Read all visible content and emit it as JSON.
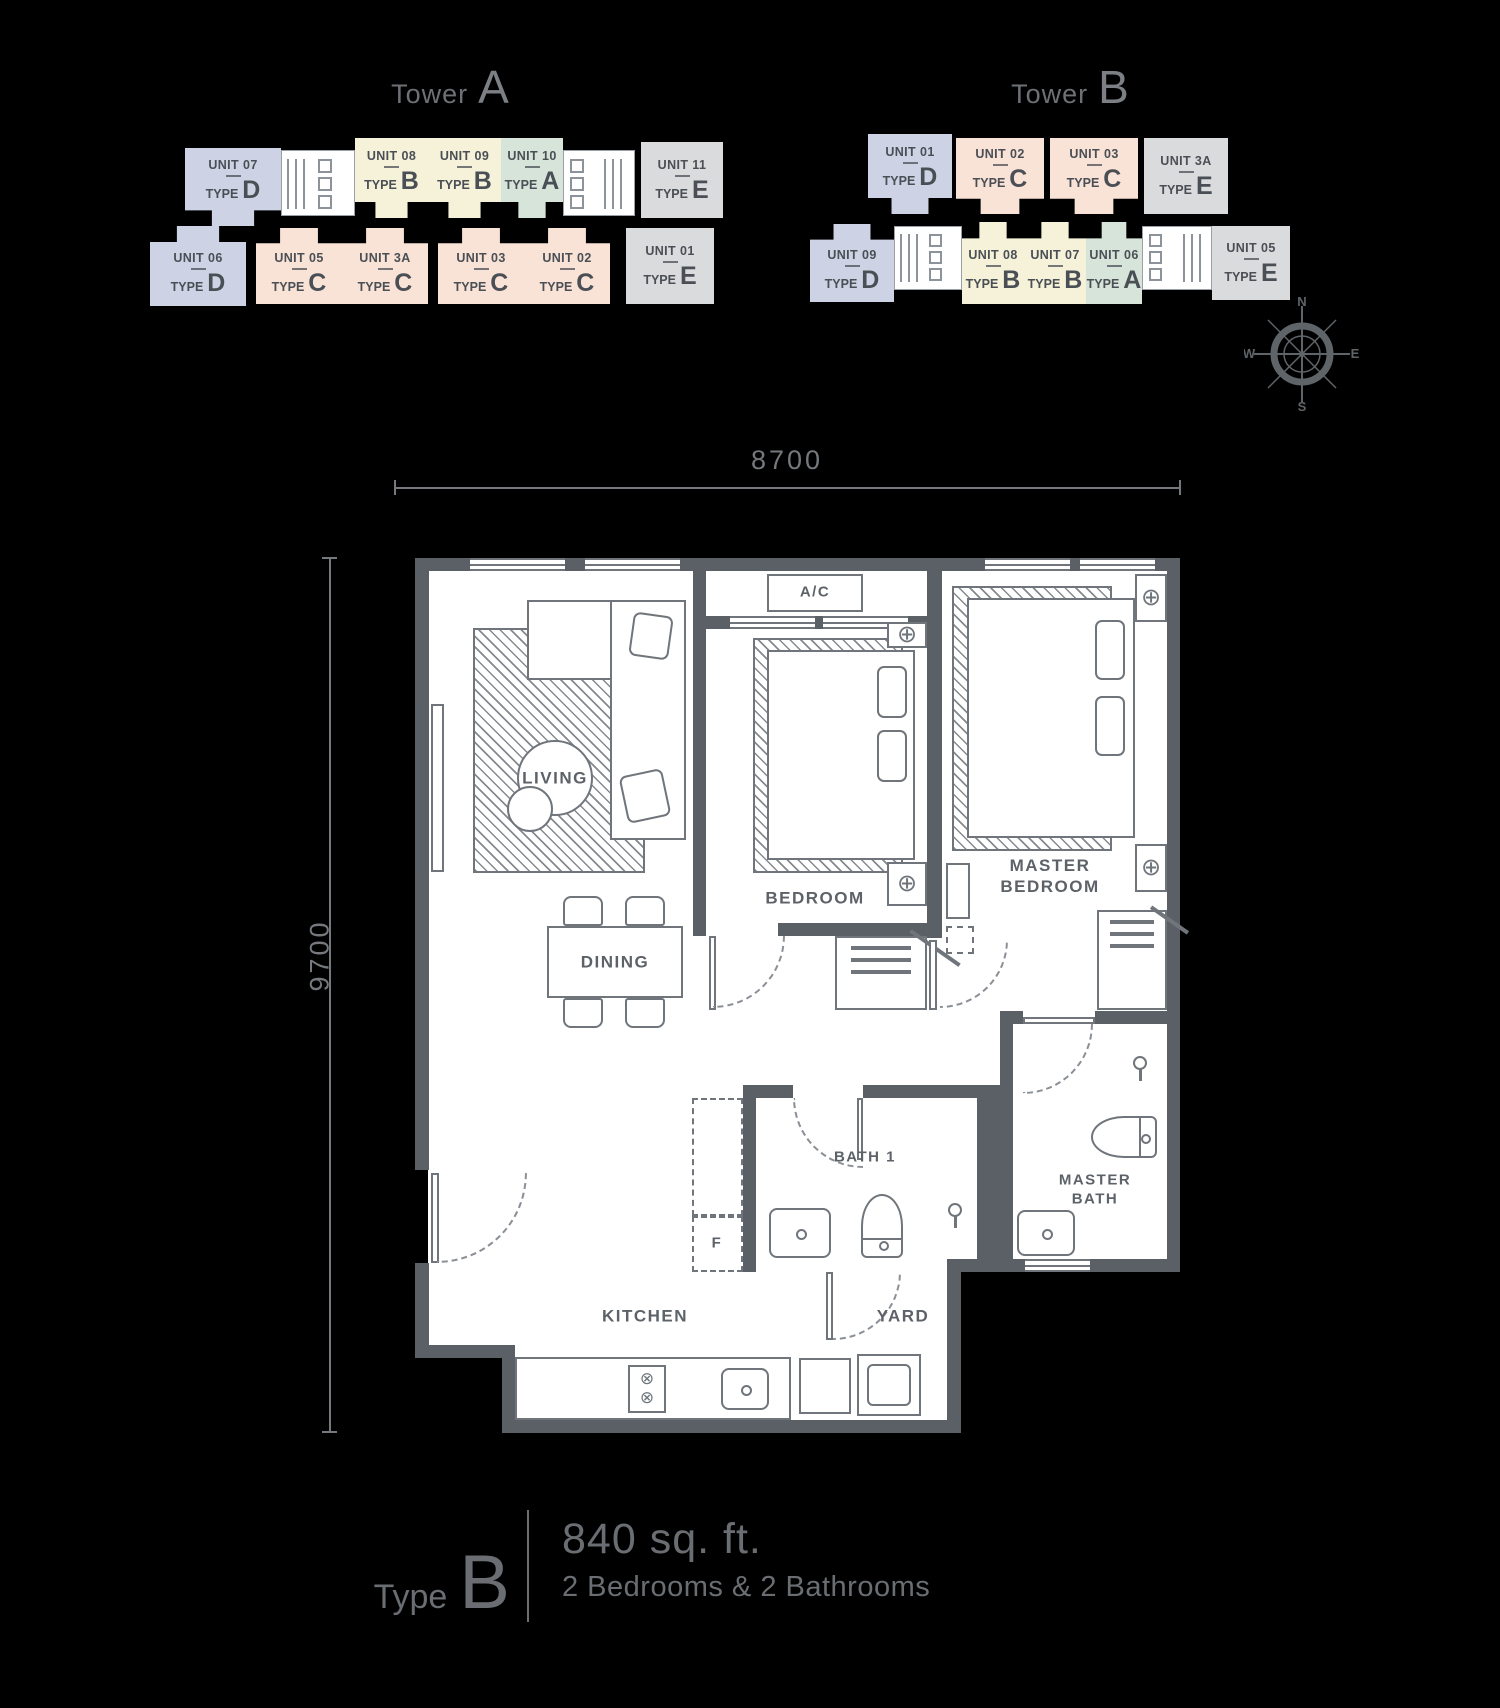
{
  "towers": [
    {
      "label": "Tower",
      "letter": "A",
      "row1": [
        {
          "unit": "UNIT 07",
          "letter": "D"
        },
        {
          "unit": "UNIT 08",
          "letter": "B"
        },
        {
          "unit": "UNIT 09",
          "letter": "B"
        },
        {
          "unit": "UNIT 10",
          "letter": "A"
        },
        {
          "unit": "UNIT 11",
          "letter": "E"
        }
      ],
      "row2": [
        {
          "unit": "UNIT 06",
          "letter": "D"
        },
        {
          "unit": "UNIT 05",
          "letter": "C"
        },
        {
          "unit": "UNIT 3A",
          "letter": "C"
        },
        {
          "unit": "UNIT 03",
          "letter": "C"
        },
        {
          "unit": "UNIT 02",
          "letter": "C"
        },
        {
          "unit": "UNIT 01",
          "letter": "E"
        }
      ]
    },
    {
      "label": "Tower",
      "letter": "B",
      "row1": [
        {
          "unit": "UNIT 01",
          "letter": "D"
        },
        {
          "unit": "UNIT 02",
          "letter": "C"
        },
        {
          "unit": "UNIT 03",
          "letter": "C"
        },
        {
          "unit": "UNIT 3A",
          "letter": "E"
        }
      ],
      "row2": [
        {
          "unit": "UNIT 09",
          "letter": "D"
        },
        {
          "unit": "UNIT 08",
          "letter": "B"
        },
        {
          "unit": "UNIT 07",
          "letter": "B"
        },
        {
          "unit": "UNIT 06",
          "letter": "A"
        },
        {
          "unit": "UNIT 05",
          "letter": "E"
        }
      ]
    }
  ],
  "labels": {
    "type_word": "TYPE"
  },
  "type_colors": {
    "A": "#d6e4d9",
    "B": "#f6f2d9",
    "C": "#f9e2d6",
    "D": "#cdd3e5",
    "E": "#dadbdd"
  },
  "compass": {
    "n": "N",
    "e": "E",
    "s": "S",
    "w": "W"
  },
  "dimensions": {
    "width": "8700",
    "height": "9700"
  },
  "rooms": {
    "living": "LIVING",
    "dining": "DINING",
    "bedroom": "BEDROOM",
    "master_bedroom": "MASTER BEDROOM",
    "bath1": "BATH 1",
    "master_bath": "MASTER BATH",
    "kitchen": "KITCHEN",
    "yard": "YARD",
    "ac": "A/C",
    "fridge": "F"
  },
  "legend": {
    "type_label": "Type",
    "type_letter": "B",
    "area": "840 sq. ft.",
    "config": "2 Bedrooms & 2 Bathrooms"
  }
}
